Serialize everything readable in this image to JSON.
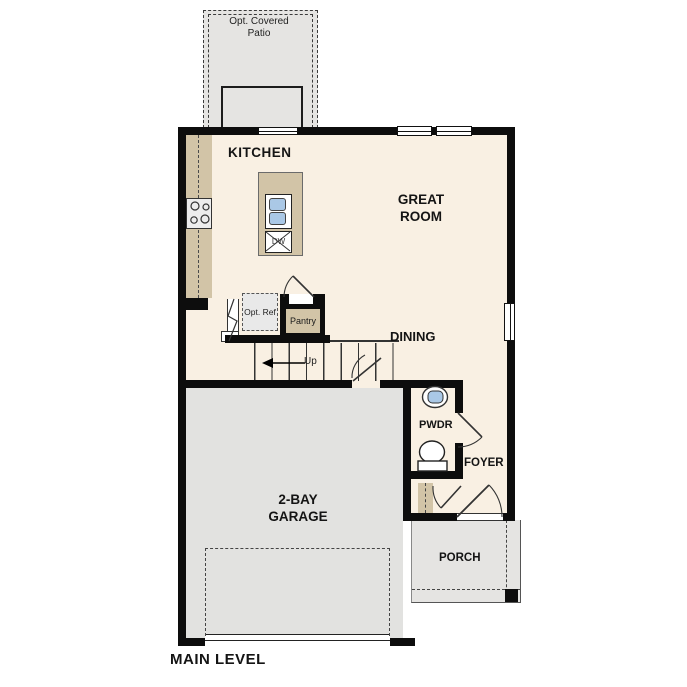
{
  "labels": {
    "patio": "Opt. Covered Patio",
    "kitchen": "KITCHEN",
    "great_room": "GREAT ROOM",
    "dining": "DINING",
    "pantry": "Pantry",
    "opt_ref": "Opt. Ref",
    "dishwasher": "DW",
    "stairs_up": "Up",
    "powder": "PWDR",
    "foyer": "FOYER",
    "garage": "2-BAY GARAGE",
    "porch": "PORCH",
    "plan_title": "MAIN LEVEL"
  },
  "colors": {
    "floor": "#f9f0e3",
    "hardscape": "#e5e4e2",
    "garage_floor": "#e2e2e0",
    "cabinet": "#d2c4a7",
    "fixture_blue": "#aac8e6",
    "wall": "#0d0d0d"
  }
}
